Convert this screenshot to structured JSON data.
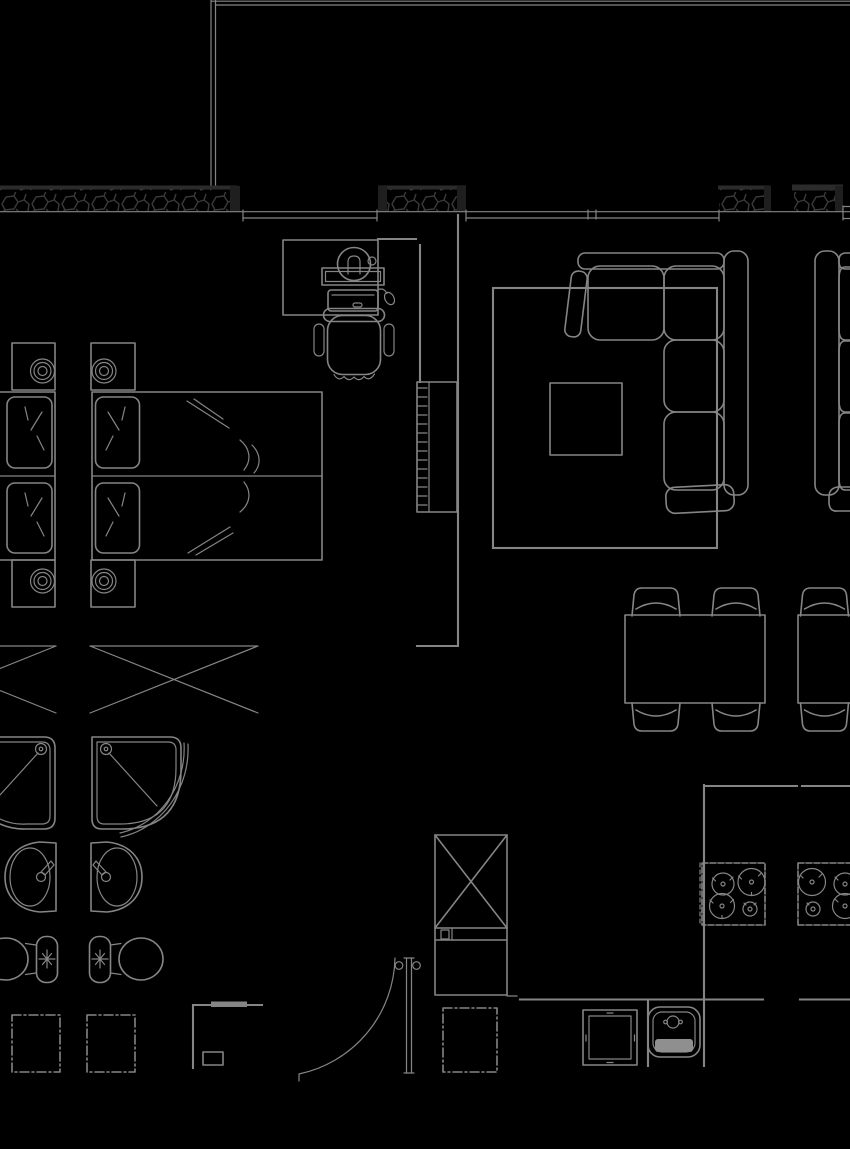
{
  "meta": {
    "title": "Apartment floor plan — black-background CAD drawing with bedroom, bathroom, living room, dining area and kitchen; mirrored neighbouring units partially visible at the left and right image edges",
    "type": "architectural-floor-plan",
    "canvas_width": 850,
    "canvas_height": 1149,
    "has_text_labels": false
  },
  "colors": {
    "background": "#000000",
    "line": "#858585",
    "insulation_hatch": "#3a3a3a",
    "wall_cap": "#1f1f1f",
    "band_edge": "#2b2b2b",
    "sink_drain_fill": "#8f8f8f"
  },
  "elements": [
    {
      "id": "balcony-boundary",
      "label": "thin double boundary line of balcony/facade, top and upper-left",
      "bbox": [
        211,
        0,
        639,
        190
      ]
    },
    {
      "id": "exterior-wall-band",
      "label": "hatched exterior insulated wall band with dark end caps and four segments",
      "bbox": [
        0,
        185,
        850,
        27
      ]
    },
    {
      "id": "window-glazing",
      "label": "continuous double glazing lines with jamb and mullion ticks",
      "bbox": [
        0,
        211,
        850,
        10
      ]
    },
    {
      "id": "desk",
      "label": "desk with lamp, shelf bar, laptop and mouse",
      "bbox": [
        283,
        240,
        112,
        75
      ]
    },
    {
      "id": "office-chair",
      "label": "office swivel chair with armrests",
      "bbox": [
        314,
        308,
        80,
        75
      ]
    },
    {
      "id": "wardrobe",
      "label": "wardrobe with hanging rail ticks and internal divider",
      "bbox": [
        417,
        382,
        40,
        130
      ]
    },
    {
      "id": "bed-main",
      "label": "double bed with two pillows, duvet fold lines and centre seam",
      "bbox": [
        92,
        392,
        230,
        168
      ]
    },
    {
      "id": "nightstands",
      "label": "four nightstands with concentric-circle table lamps",
      "bbox": [
        12,
        343,
        123,
        264
      ]
    },
    {
      "id": "bed-neighbor",
      "label": "mirrored bed of adjacent unit cut by left edge",
      "bbox": [
        0,
        392,
        55,
        168
      ]
    },
    {
      "id": "closet-x-symbols",
      "label": "two crossed-diagonal closet/luggage symbols",
      "bbox": [
        0,
        646,
        258,
        67
      ]
    },
    {
      "id": "shower-pair",
      "label": "two mirrored quarter-round shower trays with heads and door arcs",
      "bbox": [
        0,
        737,
        188,
        100
      ]
    },
    {
      "id": "washbasin-pair",
      "label": "two mirrored oval washbasins with faucets",
      "bbox": [
        3,
        842,
        139,
        71
      ]
    },
    {
      "id": "toilet-pair",
      "label": "two mirrored toilets with cisterns and flush marks",
      "bbox": [
        0,
        936,
        163,
        46
      ]
    },
    {
      "id": "washer-squares",
      "label": "two tick-bordered appliance squares",
      "bbox": [
        12,
        1015,
        123,
        57
      ]
    },
    {
      "id": "hall-cabinet",
      "label": "hall cabinet outline with thick wall segment and small box",
      "bbox": [
        193,
        1001,
        69,
        67
      ]
    },
    {
      "id": "entrance-door",
      "label": "door leaf with hinge circles and quarter-circle swing arc",
      "bbox": [
        299,
        958,
        118,
        123
      ]
    },
    {
      "id": "shaft-box",
      "label": "crossed-diagonal shaft box with cabinet below",
      "bbox": [
        435,
        835,
        82,
        161
      ]
    },
    {
      "id": "dashed-cabinet",
      "label": "tick-bordered base cabinet square beside door",
      "bbox": [
        443,
        1008,
        54,
        64
      ]
    },
    {
      "id": "rug",
      "label": "large area rug rectangle",
      "bbox": [
        493,
        288,
        224,
        260
      ]
    },
    {
      "id": "coffee-table",
      "label": "square coffee table on rug",
      "bbox": [
        550,
        383,
        72,
        72
      ]
    },
    {
      "id": "sectional-sofa",
      "label": "L-shaped sectional sofa with cushions and armrests",
      "bbox": [
        568,
        251,
        180,
        261
      ]
    },
    {
      "id": "sofa-neighbor",
      "label": "mirrored sofa of adjacent unit cut by right edge",
      "bbox": [
        815,
        251,
        35,
        260
      ]
    },
    {
      "id": "dining-set",
      "label": "dining table with four curved-back chairs",
      "bbox": [
        625,
        588,
        140,
        145
      ]
    },
    {
      "id": "dining-neighbor",
      "label": "mirrored dining table edge and chairs cut by right edge",
      "bbox": [
        798,
        588,
        52,
        145
      ]
    },
    {
      "id": "kitchen-counter",
      "label": "kitchen counter lines and partition wall",
      "bbox": [
        520,
        785,
        330,
        281
      ]
    },
    {
      "id": "cooktop",
      "label": "four-burner cooktop with tick border",
      "bbox": [
        700,
        863,
        65,
        62
      ]
    },
    {
      "id": "cooktop-neighbor",
      "label": "mirrored cooktop cut by right edge",
      "bbox": [
        798,
        863,
        52,
        62
      ]
    },
    {
      "id": "kitchen-sink",
      "label": "kitchen sink with faucet and grey drainboard",
      "bbox": [
        648,
        1007,
        52,
        50
      ]
    },
    {
      "id": "dishwasher",
      "label": "double-outline appliance square with centre ticks",
      "bbox": [
        583,
        1010,
        54,
        55
      ]
    }
  ]
}
